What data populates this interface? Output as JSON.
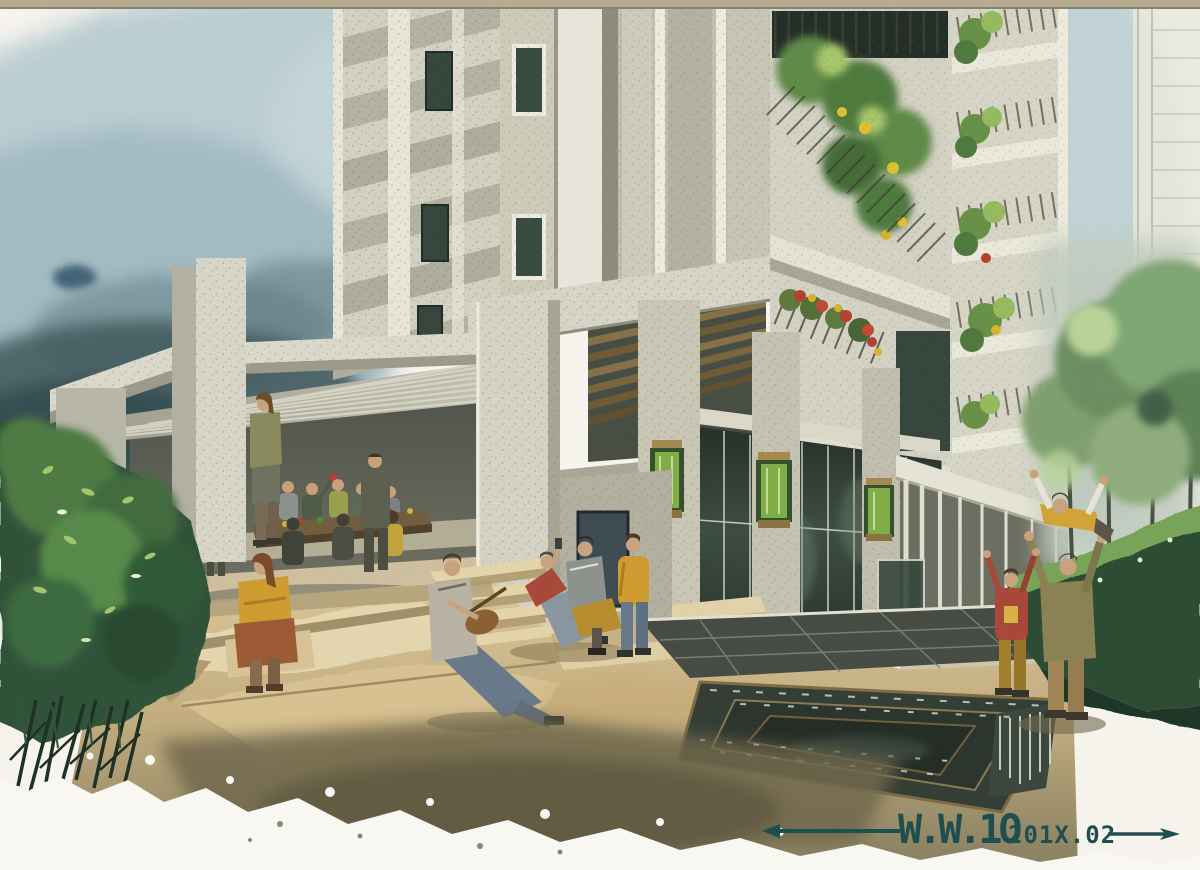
{
  "artwork": {
    "medium": "watercolor architectural rendering",
    "subject": "Residential high-rise entrance plaza with terraced courtyard, dining pavilion, water feature and figures",
    "scene": {
      "background": [
        "misty blue-grey sky wash",
        "dark wooded hills at left",
        "faint pencil-sketched building at far right"
      ],
      "buildings": [
        "left tower with diagonal zigzag balconies",
        "central concrete entrance portal with wood-slat soffit",
        "right tower with planted balconies and flower boxes",
        "ground-floor glass lobby with green lantern sconces",
        "colonnade walkway at right"
      ],
      "foreground": [
        "faceted tan plaza terraces",
        "stepped dark reflecting pool with bronze edges",
        "green shrubs at left",
        "clipped hedge and street trees at right"
      ],
      "people": [
        "group dining at long table under pavilion",
        "standing woman by pier",
        "seated woman in yellow sweater",
        "man seated playing guitar",
        "trio resting on steps",
        "child standing in yellow jacket",
        "father lifting child overhead",
        "child in red cheering"
      ]
    }
  },
  "signature": {
    "artist": "W.W.1O",
    "date": "201X.02",
    "full": "W.W.1O 201X.02",
    "color": "#1d4d4f"
  },
  "palette": {
    "paper": "#f8f6ef",
    "top_border": "#b8ac92",
    "sky_mid": "#b9cdd3",
    "sky_deep": "#8fa9b3",
    "hill_dark": "#41585c",
    "concrete_light": "#d6d4c6",
    "concrete_mid": "#b9b7a6",
    "concrete_shadow": "#8f8e7e",
    "recess_dark": "#474c43",
    "wood_slat": "#867046",
    "glass_dark": "#27332d",
    "lantern_green": "#7fae46",
    "brass": "#a3894c",
    "plaza_tan": "#dcc79b",
    "plaza_facet": "#e8dab2",
    "plaza_olive": "#6f684c",
    "water_dark": "#333d34",
    "water_edge": "#7d6b45",
    "bush_green": "#4d7a43",
    "bush_dark": "#2f5138",
    "hedge_dark": "#2c4c33",
    "tree_green": "#7fa06e",
    "fig_red": "#a8473a",
    "fig_yellow": "#cf9c2f",
    "fig_jeans": "#68798a",
    "fig_olive": "#8a8253"
  }
}
